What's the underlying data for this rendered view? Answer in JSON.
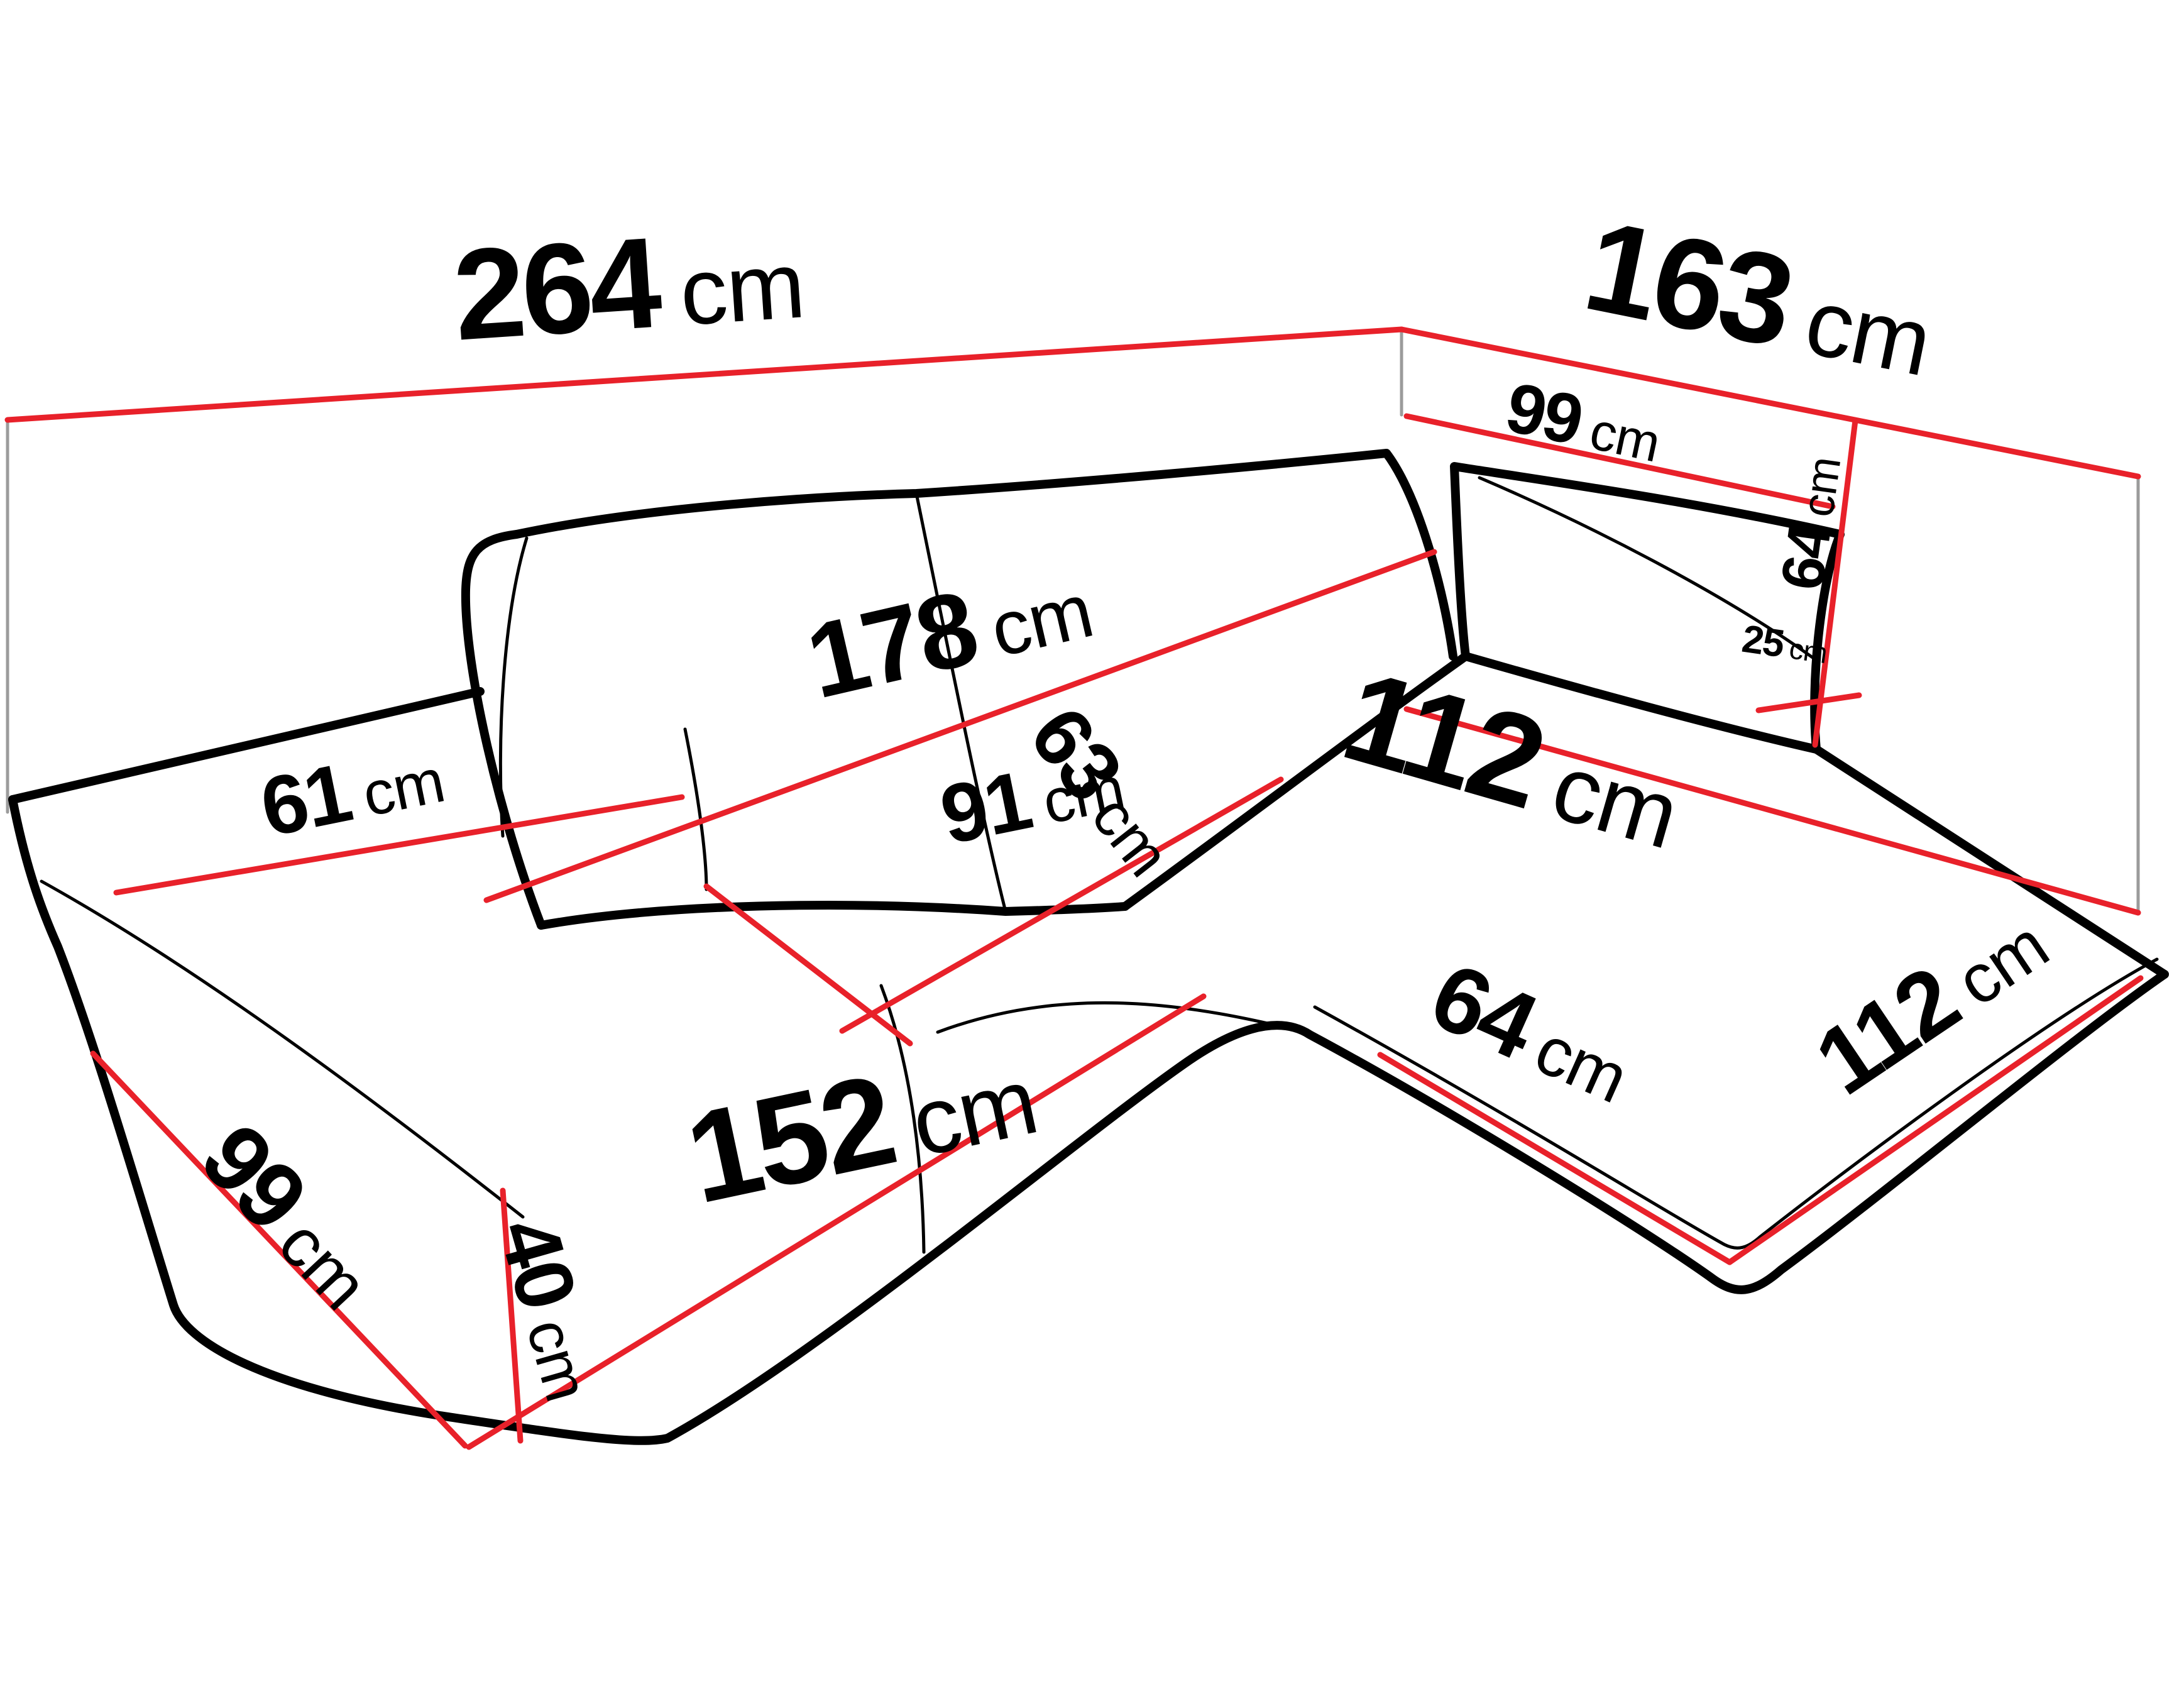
{
  "diagram": {
    "title": "corner-sofa-dimension-diagram",
    "unit": "cm",
    "colors": {
      "dimension_line": "#e8212a",
      "outline": "#000000",
      "wall_guide_line": "#9b9b9b",
      "background": "#ffffff"
    },
    "labels": [
      {
        "id": "overall-width",
        "value": "264",
        "unit": "cm"
      },
      {
        "id": "overall-depth",
        "value": "163",
        "unit": "cm"
      },
      {
        "id": "back-armrest-length",
        "value": "99",
        "unit": "cm"
      },
      {
        "id": "armrest-height",
        "value": "64",
        "unit": "cm"
      },
      {
        "id": "armrest-top-width",
        "value": "25",
        "unit": "cm"
      },
      {
        "id": "backrest-width",
        "value": "178",
        "unit": "cm"
      },
      {
        "id": "chaise-seat-length",
        "value": "112",
        "unit": "cm"
      },
      {
        "id": "seat-side-depth",
        "value": "61",
        "unit": "cm"
      },
      {
        "id": "seat-depth",
        "value": "63",
        "unit": "cm"
      },
      {
        "id": "seat-width",
        "value": "91",
        "unit": "cm"
      },
      {
        "id": "chaise-front-width",
        "value": "64",
        "unit": "cm"
      },
      {
        "id": "chaise-side-length",
        "value": "112",
        "unit": "cm"
      },
      {
        "id": "base-side-depth",
        "value": "99",
        "unit": "cm"
      },
      {
        "id": "base-height",
        "value": "40",
        "unit": "cm"
      },
      {
        "id": "front-width",
        "value": "152",
        "unit": "cm"
      }
    ]
  }
}
